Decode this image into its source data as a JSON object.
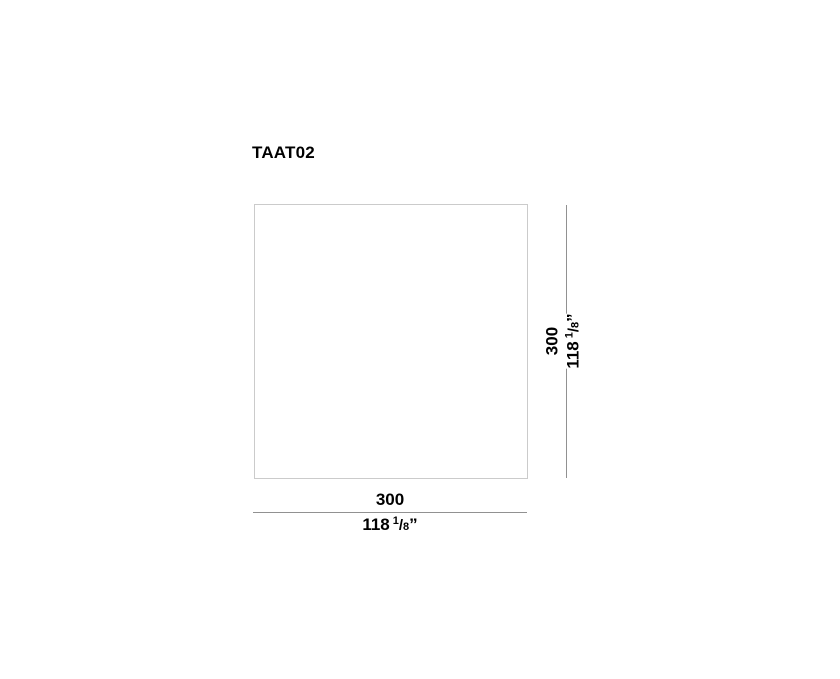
{
  "drawing": {
    "title": "TAAT02",
    "width_dimension": {
      "mm": "300",
      "inches_whole": "118",
      "fraction_numerator": "1",
      "fraction_slash": "/",
      "fraction_denominator": "8",
      "inch_mark": "”"
    },
    "height_dimension": {
      "mm": "300",
      "inches_whole": "118",
      "fraction_numerator": "1",
      "fraction_slash": "/",
      "fraction_denominator": "8",
      "inch_mark": "”"
    },
    "colors": {
      "background": "#ffffff",
      "outline": "#cbcbcb",
      "dimension_line": "#919191",
      "text": "#000000"
    }
  }
}
